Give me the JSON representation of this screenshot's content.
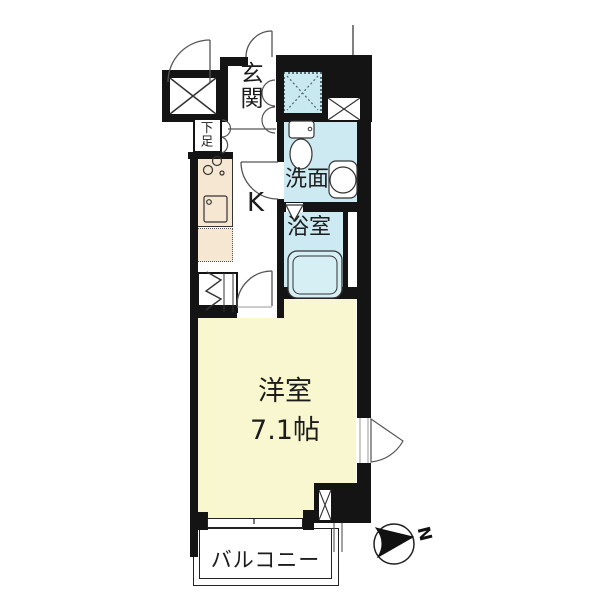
{
  "plan": {
    "type": "apartment-floor-plan",
    "labels": {
      "entrance": "玄関",
      "shoe_storage": "下足",
      "kitchen": "K",
      "washroom": "洗面",
      "bathroom": "浴室",
      "room_name": "洋室",
      "room_size": "7.1帖",
      "balcony": "バルコニー",
      "compass_north": "N"
    },
    "colors": {
      "wall": "#141414",
      "wet_area": "#cdeaf2",
      "main_room": "#f9f7cf",
      "kitchen_counter": "#f6e7d2",
      "bathtub": "#d6eff5",
      "thin_line": "#555555"
    }
  }
}
